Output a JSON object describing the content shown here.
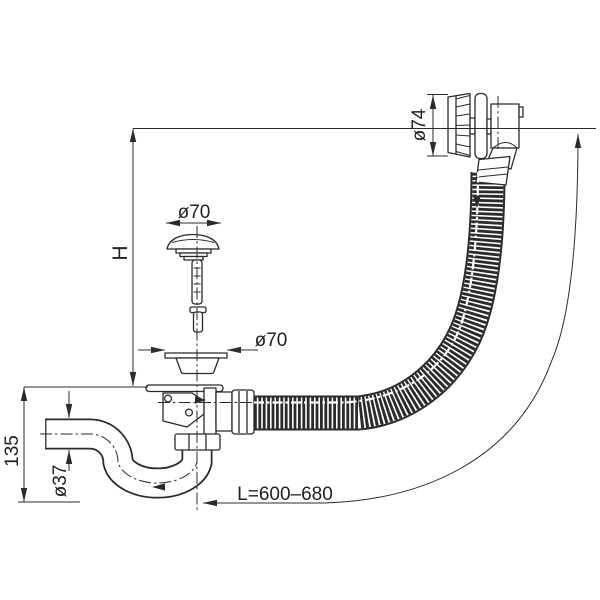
{
  "figure": {
    "title": "bath-waste-overflow-siphon-technical-drawing",
    "dimensions": {
      "overflow_diameter": "ø74",
      "plug_diameter": "ø70",
      "strainer_diameter": "ø70",
      "installation_height": "H",
      "trap_height": "135",
      "outlet_pipe_diameter": "ø37",
      "hose_length": "L=600–680"
    },
    "colors": {
      "line": "#2b2b2b",
      "background": "#ffffff"
    }
  }
}
